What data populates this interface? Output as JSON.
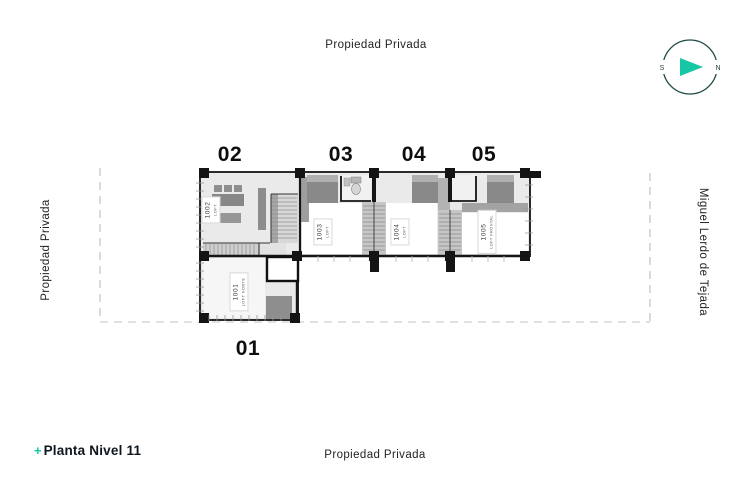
{
  "drawing": {
    "type": "architectural-floor-plan",
    "title_prefix": "+",
    "title": "Planta Nivel 11"
  },
  "streets": {
    "top": "Propiedad Privada",
    "bottom": "Propiedad Privada",
    "left": "Propiedad Privada",
    "right": "Miguel Lerdo de Tejada"
  },
  "compass": {
    "west": "S",
    "east": "N"
  },
  "unit_numbers": {
    "u01": "01",
    "u02": "02",
    "u03": "03",
    "u04": "04",
    "u05": "05"
  },
  "unit_tags": {
    "t1001": {
      "code": "1001",
      "name": "LOFT NORTE"
    },
    "t1002": {
      "code": "1002",
      "name": "LOFT"
    },
    "t1003": {
      "code": "1003",
      "name": "LOFT"
    },
    "t1004": {
      "code": "1004",
      "name": "LOFT"
    },
    "t1005": {
      "code": "1005",
      "name": "LOFT FRONTAL"
    }
  },
  "colors": {
    "accent_teal": "#15c7a5",
    "compass_ring": "#1e4a45",
    "ink": "#1f1f1f",
    "wall": "#161616",
    "building_fill": "#eaeaea",
    "furniture_gray": "#8e8e8e",
    "stair_gray": "#cbcbcb",
    "boundary_dash_gray": "#bcbcbc"
  }
}
